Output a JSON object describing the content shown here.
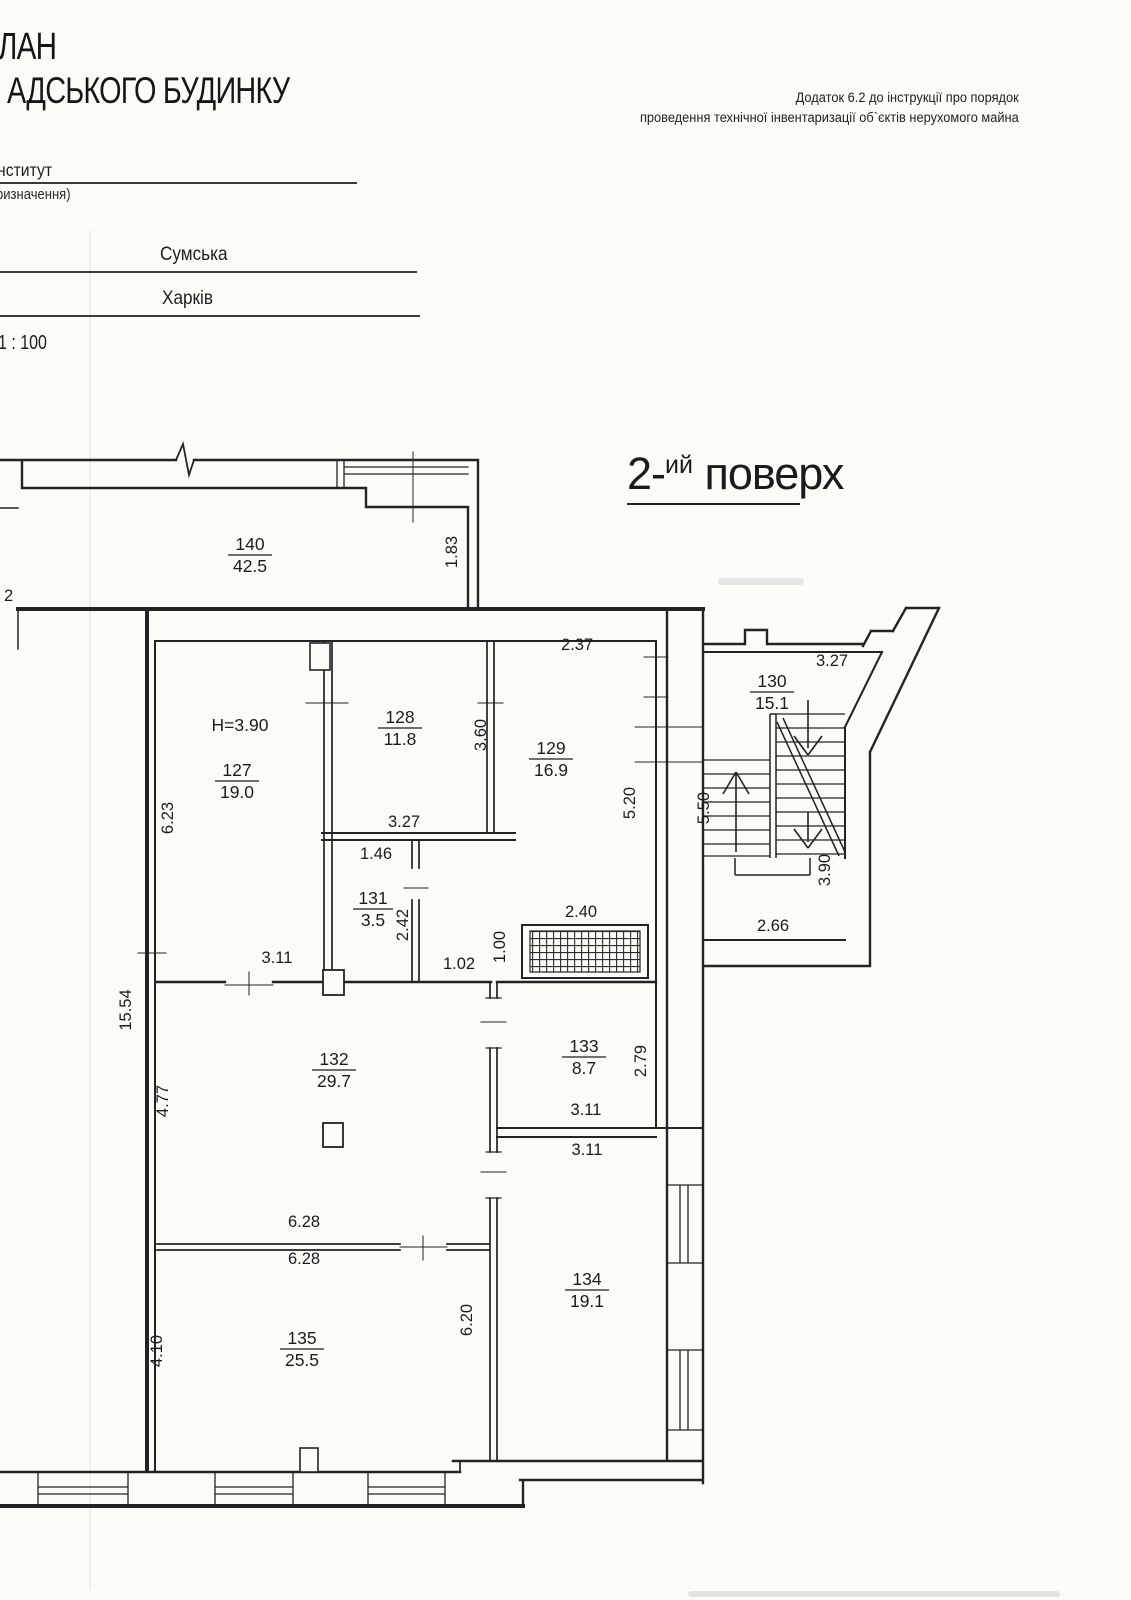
{
  "document": {
    "appendix_line1": "Додаток 6.2 до інструкції про порядок",
    "appendix_line2": "проведення технічної інвентаризації об`єктів нерухомого майна",
    "title_line1": "ЛАН",
    "title_line2": "АДСЬКОГО БУДИНКУ",
    "institute_label": "нститут",
    "purpose_label": "ризначення)",
    "street": "Сумська",
    "city": "Харків",
    "scale": "1 : 100",
    "floor_label": {
      "number": "2-",
      "suffix": "ий",
      "word": "поверх"
    }
  },
  "plan": {
    "height_note": "H=3.90",
    "rooms": [
      {
        "num": "140",
        "area": "42.5"
      },
      {
        "num": "127",
        "area": "19.0"
      },
      {
        "num": "128",
        "area": "11.8"
      },
      {
        "num": "129",
        "area": "16.9"
      },
      {
        "num": "130",
        "area": "15.1"
      },
      {
        "num": "131",
        "area": "3.5"
      },
      {
        "num": "132",
        "area": "29.7"
      },
      {
        "num": "133",
        "area": "8.7"
      },
      {
        "num": "134",
        "area": "19.1"
      },
      {
        "num": "135",
        "area": "25.5"
      }
    ],
    "dims": [
      {
        "v": "1.83"
      },
      {
        "v": "2.37"
      },
      {
        "v": "3.27"
      },
      {
        "v": "3.60"
      },
      {
        "v": "6.23"
      },
      {
        "v": "3.27"
      },
      {
        "v": "5.20"
      },
      {
        "v": "5.50"
      },
      {
        "v": "1.46"
      },
      {
        "v": "2.42"
      },
      {
        "v": "1.02"
      },
      {
        "v": "1.00"
      },
      {
        "v": "2.40"
      },
      {
        "v": "3.90"
      },
      {
        "v": "2.66"
      },
      {
        "v": "3.11"
      },
      {
        "v": "15.54"
      },
      {
        "v": "4.77"
      },
      {
        "v": "2.79"
      },
      {
        "v": "3.11"
      },
      {
        "v": "3.11"
      },
      {
        "v": "6.28"
      },
      {
        "v": "6.28"
      },
      {
        "v": "4.10"
      },
      {
        "v": "6.20"
      },
      {
        "v": "2"
      }
    ]
  },
  "colors": {
    "paper": "#fcfbf8",
    "ink": "#232323"
  }
}
